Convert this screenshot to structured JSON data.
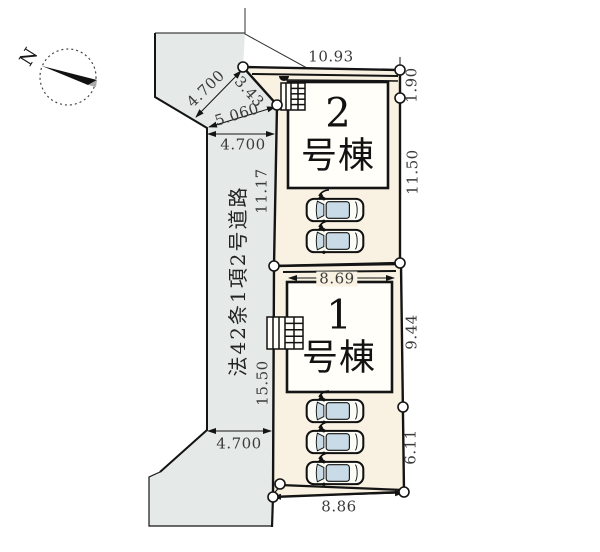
{
  "compass": {
    "north": "N"
  },
  "road": {
    "name": "法42条1項2号道路"
  },
  "buildings": {
    "b2": {
      "number": "2",
      "suffix": "号棟"
    },
    "b1": {
      "number": "1",
      "suffix": "号棟"
    }
  },
  "dimensions": {
    "plot2_top": "10.93",
    "plot2_right_upper": "1.90",
    "plot2_right_lower": "11.50",
    "plot2_west": "11.17",
    "corner_road_width": "4.700",
    "corner_splay": "5.060",
    "corner_cut": "3.43",
    "road_width_upper": "4.700",
    "road_width_lower": "4.700",
    "plot1_inner_top": "8.69",
    "plot1_right_upper": "9.44",
    "plot1_right_lower": "6.11",
    "plot1_west": "15.50",
    "plot1_bottom": "8.86"
  }
}
